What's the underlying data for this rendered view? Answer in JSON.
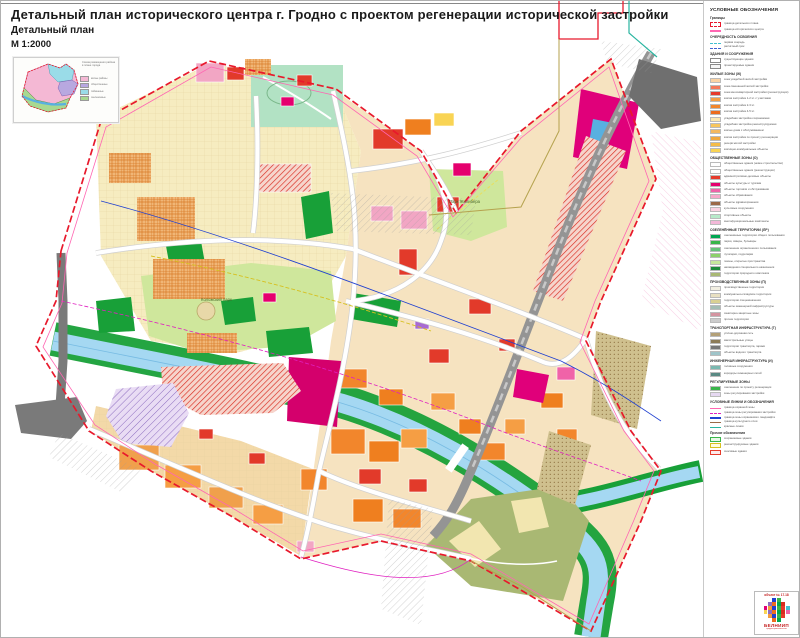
{
  "header": {
    "title": "Детальный план исторического центра г. Гродно с проектом регенерации исторической застройки",
    "subtitle": "Детальный план",
    "scale": "М  1:2000"
  },
  "inset": {
    "note": "Схема размещения района в плане города",
    "legend": [
      {
        "color": "#f4b8d4",
        "label": "жилые районы"
      },
      {
        "color": "#b8a8e0",
        "label": "общественные"
      },
      {
        "color": "#9adce8",
        "label": "пойменные"
      },
      {
        "color": "#a8d890",
        "label": "озеленённые"
      }
    ]
  },
  "map_labels": {
    "park1": "Коложский парк",
    "park2": "Парк Жилибера"
  },
  "colors": {
    "river": "#a5d8f2",
    "park_light": "#cfe79c",
    "forest": "#18a038",
    "boundary_red": "#e8192c",
    "railway_grey": "#949494",
    "magenta_zone": "#e0007a"
  },
  "legend": {
    "title": "УСЛОВНЫЕ ОБОЗНАЧЕНИЯ",
    "sections": [
      {
        "header": "Границы",
        "rows": [
          {
            "c": "#ffffff",
            "h": "outline-red-dash",
            "t": "граница детального плана"
          },
          {
            "c": "#ff66b2",
            "h": "line",
            "t": "граница исторического центра"
          }
        ]
      },
      {
        "header": "ОЧЕРЕДНОСТЬ ОСВОЕНИЯ",
        "rows": [
          {
            "c": "#40c0d0",
            "h": "dash",
            "t": "первая очередь"
          },
          {
            "c": "#4060d0",
            "h": "dash",
            "t": "расчётный срок"
          }
        ]
      },
      {
        "header": "ЗДАНИЯ И СООРУЖЕНИЯ",
        "rows": [
          {
            "c": "#ffffff",
            "h": "outline",
            "t": "существующие здания"
          },
          {
            "c": "#f4f4f4",
            "h": "outline",
            "t": "проектируемые здания"
          }
        ]
      },
      {
        "header": "ЖИЛЫЕ ЗОНЫ (Ж)",
        "rows": [
          {
            "c": "#fbd3a4",
            "t": "зона усадебной жилой застройки"
          },
          {
            "c": "#f4785a",
            "t": "зона смешанной жилой застройки"
          },
          {
            "c": "#e63b2c",
            "t": "зона многоквартирной застройки (реконструкция)"
          },
          {
            "c": "#f59e44",
            "t": "жилая застройка 1-2 эт. с участками"
          },
          {
            "c": "#f2862c",
            "t": "жилая застройка 2-3 эт."
          },
          {
            "c": "#ec6c1e",
            "t": "жилая застройка 4-5 эт."
          },
          {
            "c": "#fbe9b4",
            "t": "усадебная застройка сохраняемая"
          },
          {
            "c": "#f7c65e",
            "t": "усадебная застройка реконструируемая"
          },
          {
            "c": "#f3b860",
            "t": "жилые дома с обслуживанием"
          },
          {
            "c": "#f0a83e",
            "t": "жилая застройка по проекту регенерации"
          },
          {
            "c": "#f5bc48",
            "t": "резерв жилой застройки"
          },
          {
            "c": "#f9d454",
            "t": "жилищно-коммунальные объекты"
          }
        ]
      },
      {
        "header": "ОБЩЕСТВЕННЫЕ ЗОНЫ (О)",
        "rows": [
          {
            "c": "#ffffff",
            "h": "diag-red",
            "t": "общественные здания (новое строительство)"
          },
          {
            "c": "#ffffff",
            "h": "dots-red",
            "t": "общественные здания (реконструкция)"
          },
          {
            "c": "#e63b2c",
            "t": "административно-деловые объекты"
          },
          {
            "c": "#e5006e",
            "t": "объекты культуры и туризма"
          },
          {
            "c": "#f063a8",
            "t": "объекты торговли и обслуживания"
          },
          {
            "c": "#f8a9ca",
            "t": "объекты образования"
          },
          {
            "c": "#9b6a48",
            "t": "объекты здравоохранения"
          },
          {
            "c": "#fbd3e2",
            "t": "культовые сооружения"
          },
          {
            "c": "#b7e9c9",
            "t": "спортивные объекты"
          },
          {
            "c": "#f2b8d8",
            "h": "diag-pink",
            "t": "многофункциональные комплексы"
          }
        ]
      },
      {
        "header": "ОЗЕЛЕНЁННЫЕ ТЕРРИТОРИИ (ЛР)",
        "rows": [
          {
            "c": "#00a651",
            "t": "озеленённые территории общего пользования"
          },
          {
            "c": "#39b54a",
            "t": "парки, скверы, бульвары"
          },
          {
            "c": "#66c27a",
            "t": "озеленение ограниченного пользования"
          },
          {
            "c": "#8dd06a",
            "t": "лугопарки, гидропарки"
          },
          {
            "c": "#c5e79c",
            "t": "газоны, открытые пространства"
          },
          {
            "c": "#1d8a3c",
            "t": "насаждения специального назначения"
          },
          {
            "c": "#a9b873",
            "t": "территории природного комплекса"
          }
        ]
      },
      {
        "header": "ПРОИЗВОДСТВЕННЫЕ ЗОНЫ (П)",
        "rows": [
          {
            "c": "#f2efe2",
            "t": "производственные территории"
          },
          {
            "c": "#e8e0c2",
            "t": "коммунально-складские территории"
          },
          {
            "c": "#d9d092",
            "t": "территории спецназначения"
          },
          {
            "c": "#a3bdb4",
            "t": "объекты инженерной инфраструктуры"
          },
          {
            "c": "#d494a0",
            "t": "санитарно-защитные зоны"
          },
          {
            "c": "#cccccc",
            "t": "прочие территории"
          }
        ]
      },
      {
        "header": "ТРАНСПОРТНАЯ ИНФРАСТРУКТУРА (Т)",
        "rows": [
          {
            "c": "#b3a077",
            "t": "улично-дорожная сеть"
          },
          {
            "c": "#8c7b57",
            "t": "магистральные улицы"
          },
          {
            "c": "#777777",
            "t": "территории транспорта, гаражи"
          },
          {
            "c": "#9fc4c9",
            "t": "объекты водного транспорта"
          }
        ]
      },
      {
        "header": "ИНЖЕНЕРНАЯ ИНФРАСТРУКТУРА (И)",
        "rows": [
          {
            "c": "#7ab8b0",
            "t": "головные сооружения"
          },
          {
            "c": "#5a8a84",
            "t": "коридоры инженерных сетей"
          }
        ]
      },
      {
        "header": "РЕГУЛИРУЕМЫЕ ЗОНЫ",
        "rows": [
          {
            "c": "#39b54a",
            "t": "озеленение по проекту регенерации"
          },
          {
            "c": "#e6d8f2",
            "h": "diag-purple",
            "t": "зоны регулирования застройки"
          }
        ]
      },
      {
        "header": "УСЛОВНЫЕ ЛИНИИ И ОБОЗНАЧЕНИЯ",
        "rows": [
          {
            "c": "#ff66b2",
            "h": "line",
            "t": "граница охранной зоны"
          },
          {
            "c": "#e020c0",
            "h": "dash",
            "t": "граница зоны регулирования застройки"
          },
          {
            "c": "#2040d0",
            "h": "line",
            "t": "граница зоны охраняемого ландшафта"
          },
          {
            "c": "#9b6a48",
            "h": "line",
            "t": "граница культурного слоя"
          },
          {
            "c": "#2ab5a0",
            "h": "line",
            "t": "красные линии"
          }
        ]
      },
      {
        "header": "Прочие обозначения",
        "rows": [
          {
            "c": "#e8f8e8",
            "h": "outline-green",
            "t": "сохраняемые здания"
          },
          {
            "c": "#fdfbe0",
            "h": "outline-yellow",
            "t": "реконструируемые здания"
          },
          {
            "c": "#fdeaea",
            "h": "outline-red",
            "t": "сносимые здания"
          }
        ]
      }
    ]
  },
  "stamp": {
    "object": "объект № 17.18",
    "brand": "БЕЛНИИП",
    "sub": "градостроительства",
    "logo_colors": [
      "#e0007a",
      "#f59b3c",
      "#2040d0",
      "#39b54a",
      "#e63b2c",
      "#40c0d0",
      "#f9d454",
      "#8e6ec0",
      "#ec6c1e",
      "#00a651",
      "#d92b1f",
      "#f063a8"
    ]
  }
}
